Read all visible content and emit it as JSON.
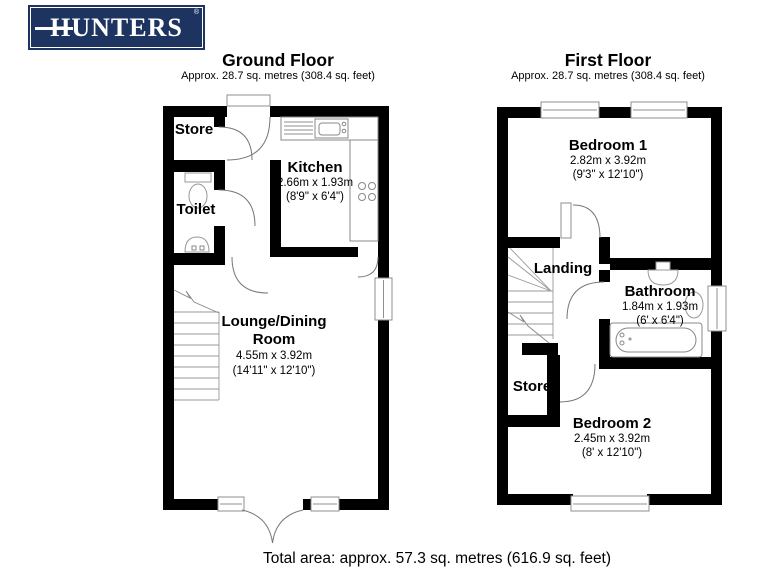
{
  "logo": {
    "text": "HUNTERS",
    "registered": "®",
    "brand_color": "#1d3360"
  },
  "ground_floor": {
    "title": "Ground Floor",
    "subtitle": "Approx. 28.7 sq. metres (308.4 sq. feet)",
    "rooms": {
      "store": {
        "name": "Store"
      },
      "toilet": {
        "name": "Toilet"
      },
      "kitchen": {
        "name": "Kitchen",
        "dims_metric": "2.66m x 1.93m",
        "dims_imperial": "(8'9\" x 6'4\")"
      },
      "lounge": {
        "name_line1": "Lounge/Dining",
        "name_line2": "Room",
        "dims_metric": "4.55m x 3.92m",
        "dims_imperial": "(14'11\" x 12'10\")"
      }
    }
  },
  "first_floor": {
    "title": "First Floor",
    "subtitle": "Approx. 28.7 sq. metres (308.4 sq. feet)",
    "rooms": {
      "bedroom1": {
        "name": "Bedroom 1",
        "dims_metric": "2.82m x 3.92m",
        "dims_imperial": "(9'3\" x 12'10\")"
      },
      "landing": {
        "name": "Landing"
      },
      "bathroom": {
        "name": "Bathroom",
        "dims_metric": "1.84m x 1.93m",
        "dims_imperial": "(6' x 6'4\")"
      },
      "store": {
        "name": "Store"
      },
      "bedroom2": {
        "name": "Bedroom 2",
        "dims_metric": "2.45m x 3.92m",
        "dims_imperial": "(8' x 12'10\")"
      }
    }
  },
  "footer": {
    "total_area": "Total area: approx. 57.3 sq. metres (616.9 sq. feet)"
  }
}
